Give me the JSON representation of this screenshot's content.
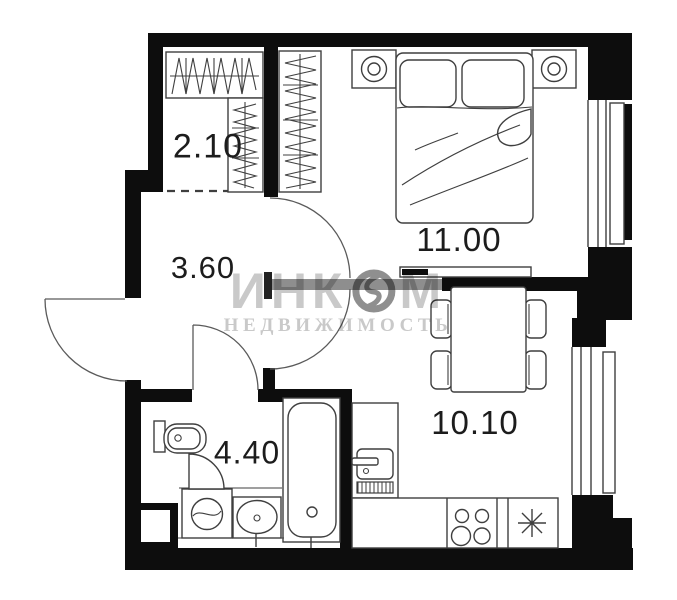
{
  "watermark": {
    "brand_prefix": "ИНК",
    "brand_suffix": "М",
    "subtitle": "НЕДВИЖИМОСТЬ"
  },
  "rooms": [
    {
      "id": "wardrobe",
      "area": "2.10"
    },
    {
      "id": "hallway",
      "area": "3.60"
    },
    {
      "id": "bedroom",
      "area": "11.00"
    },
    {
      "id": "kitchen",
      "area": "10.10"
    },
    {
      "id": "bathroom",
      "area": "4.40"
    }
  ],
  "colors": {
    "wall": "#0d0d0d",
    "line": "#3f3f3f",
    "partition": "#8e8e8e",
    "label": "#1c1c1c",
    "watermark": "#c9c9c9",
    "watermark-logo": "#8f8f8f",
    "bg": "#ffffff"
  }
}
